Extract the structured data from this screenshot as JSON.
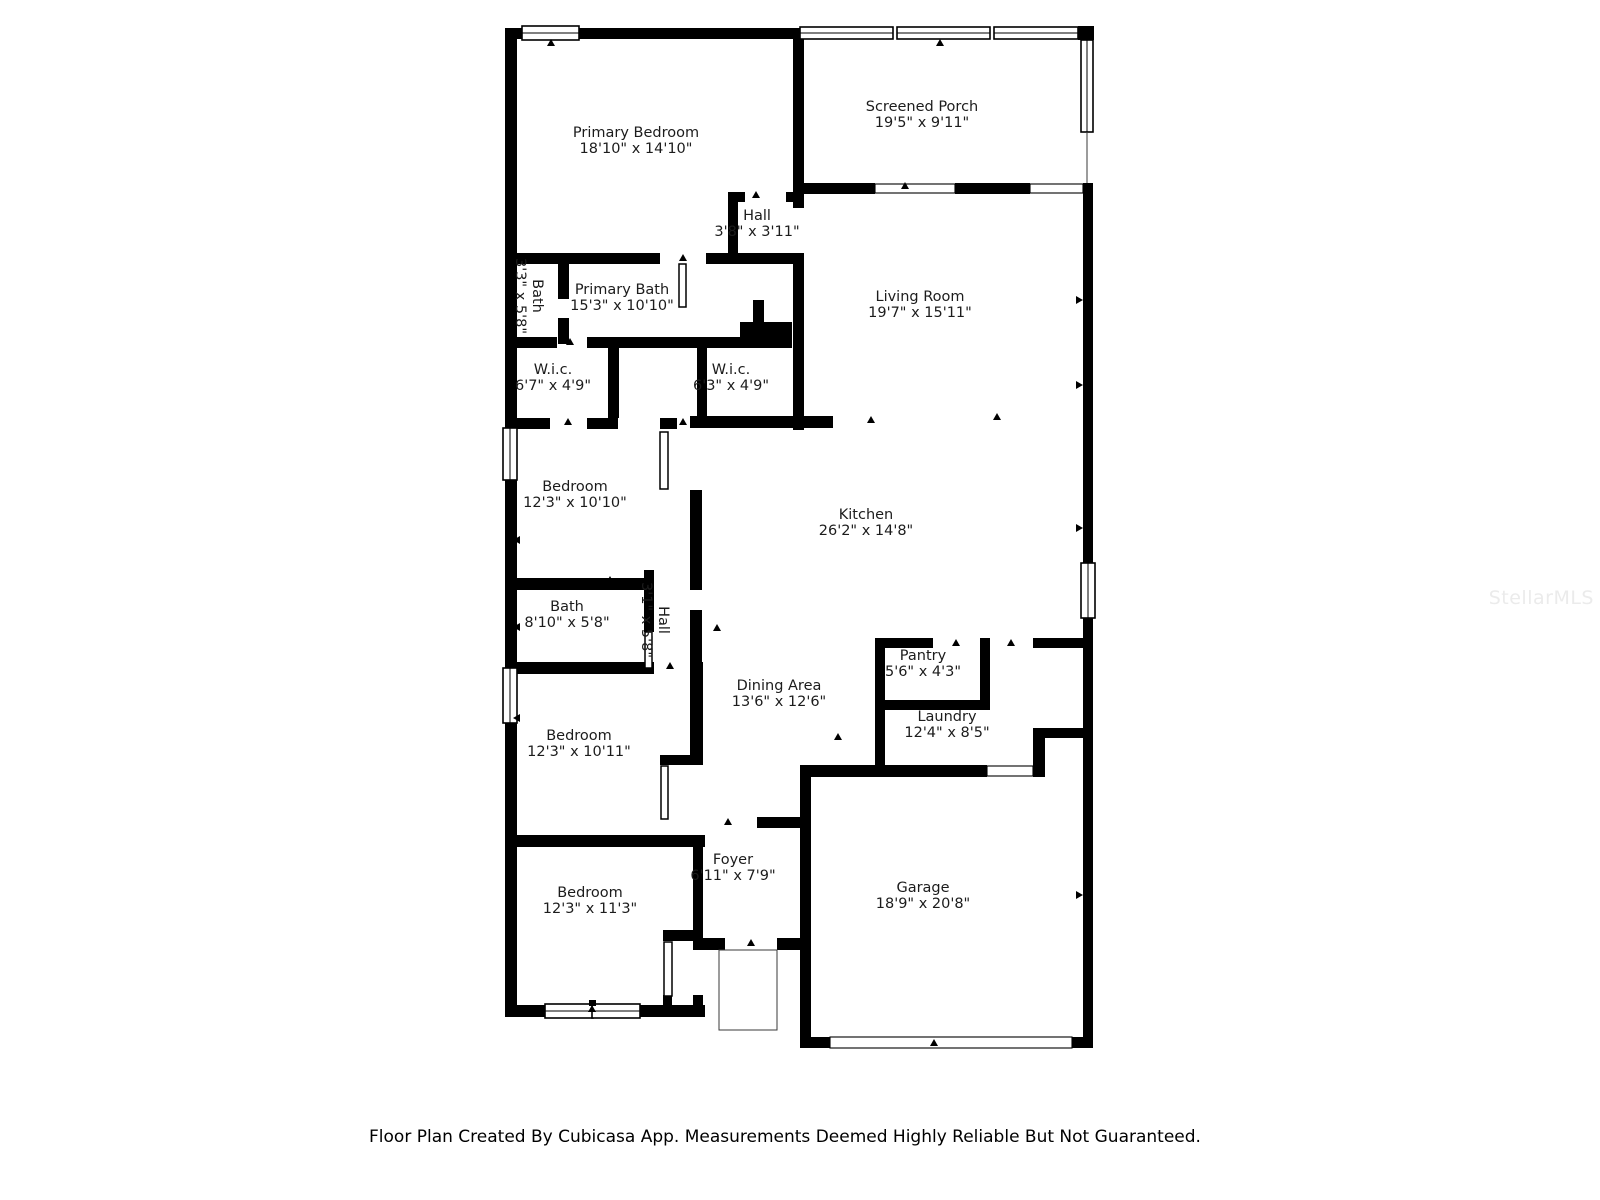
{
  "colors": {
    "wall": "#000000",
    "label_text": "#1c1c1c",
    "footer_text": "#000000",
    "watermark": "#ebebeb",
    "background": "#ffffff"
  },
  "watermark": "StellarMLS",
  "footer": "Floor Plan Created By Cubicasa App. Measurements Deemed Highly Reliable But Not Guaranteed.",
  "rooms": [
    {
      "name": "Primary Bedroom",
      "dims": "18'10\" x 14'10\""
    },
    {
      "name": "Screened Porch",
      "dims": "19'5\" x 9'11\""
    },
    {
      "name": "Hall",
      "dims": "3'8\" x 3'11\""
    },
    {
      "name": "Primary Bath",
      "dims": "15'3\" x 10'10\""
    },
    {
      "name": "Bath",
      "dims": "3'3\" x 5'8\""
    },
    {
      "name": "W.i.c.",
      "dims": "6'7\" x 4'9\""
    },
    {
      "name": "W.i.c.",
      "dims": "6'3\" x 4'9\""
    },
    {
      "name": "Living Room",
      "dims": "19'7\" x 15'11\""
    },
    {
      "name": "Bedroom",
      "dims": "12'3\" x 10'10\""
    },
    {
      "name": "Kitchen",
      "dims": "26'2\" x 14'8\""
    },
    {
      "name": "Bath",
      "dims": "8'10\" x 5'8\""
    },
    {
      "name": "Hall",
      "dims": "3'1\" x 5'8\""
    },
    {
      "name": "Pantry",
      "dims": "5'6\" x 4'3\""
    },
    {
      "name": "Dining Area",
      "dims": "13'6\" x 12'6\""
    },
    {
      "name": "Laundry",
      "dims": "12'4\" x 8'5\""
    },
    {
      "name": "Bedroom",
      "dims": "12'3\" x 10'11\""
    },
    {
      "name": "Foyer",
      "dims": "6'11\" x 7'9\""
    },
    {
      "name": "Bedroom",
      "dims": "12'3\" x 11'3\""
    },
    {
      "name": "Garage",
      "dims": "18'9\" x 20'8\""
    }
  ]
}
